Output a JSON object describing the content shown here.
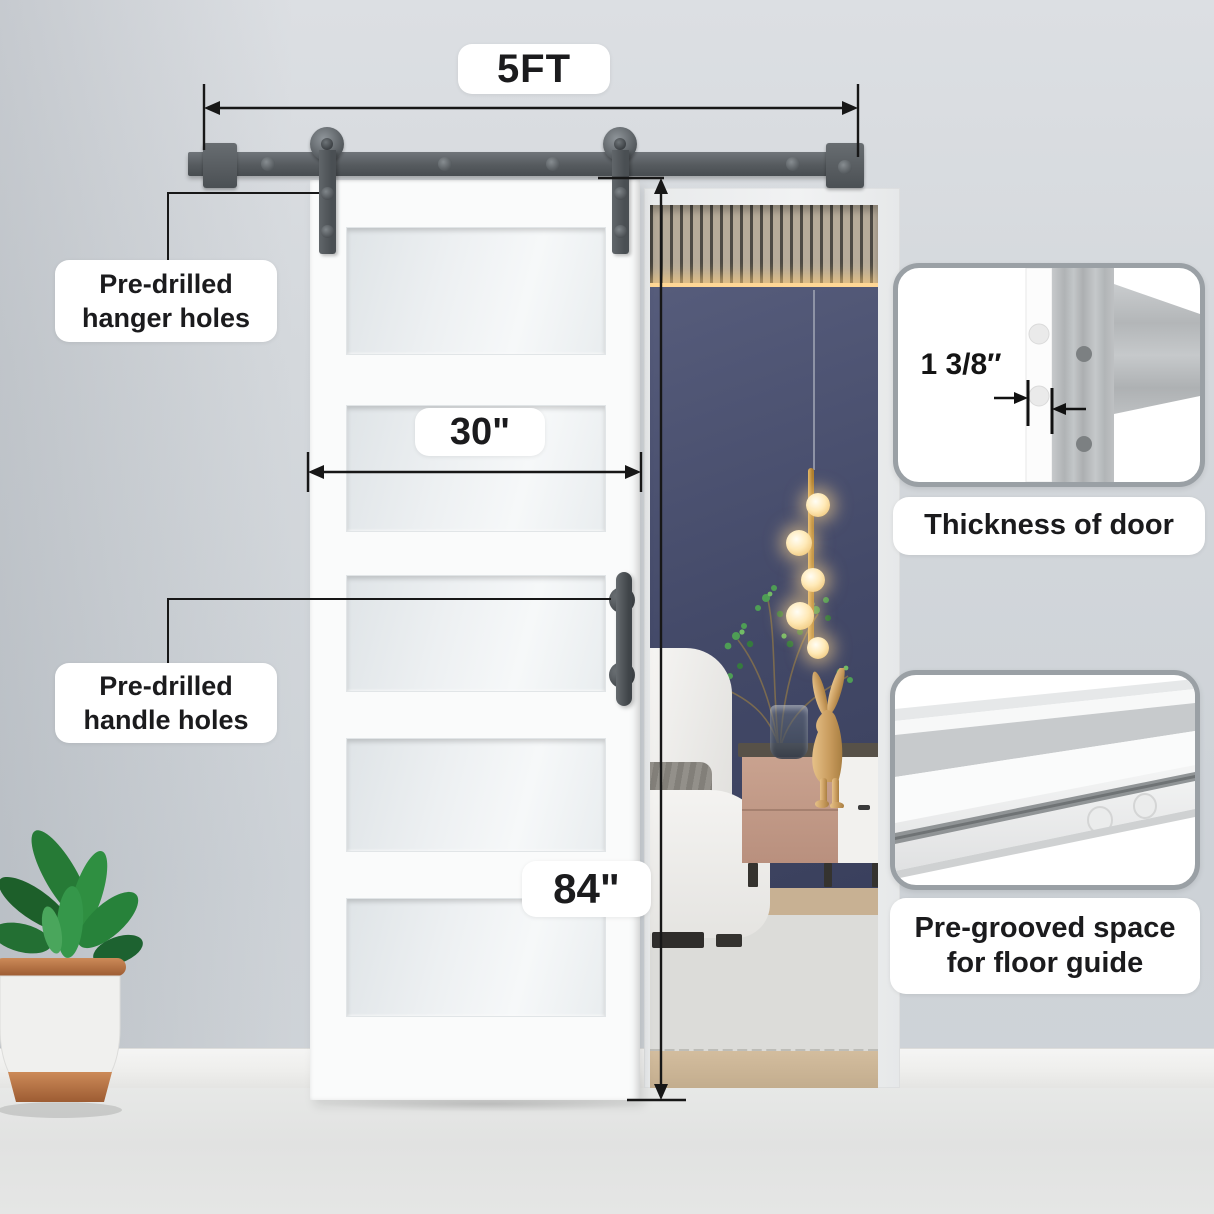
{
  "annotations": {
    "track_width_label": "5FT",
    "door_width_label": "30\"",
    "door_height_label": "84\"",
    "hanger_callout_label": "Pre-drilled hanger holes",
    "handle_callout_label": "Pre-drilled handle holes"
  },
  "insets": {
    "thickness": {
      "dimension_label": "1 3/8″",
      "caption": "Thickness of door"
    },
    "groove": {
      "caption": "Pre-grooved space for floor guide"
    }
  },
  "colors": {
    "hardware_gray": "#54595d",
    "door_white": "#fafbfb",
    "bedroom_accent_wall": "#434968",
    "label_text": "#1b1b1d",
    "inset_panel_border": "#9aa0a5",
    "copper_pot_band": "#b5764e",
    "warm_light": "#ffd795"
  }
}
